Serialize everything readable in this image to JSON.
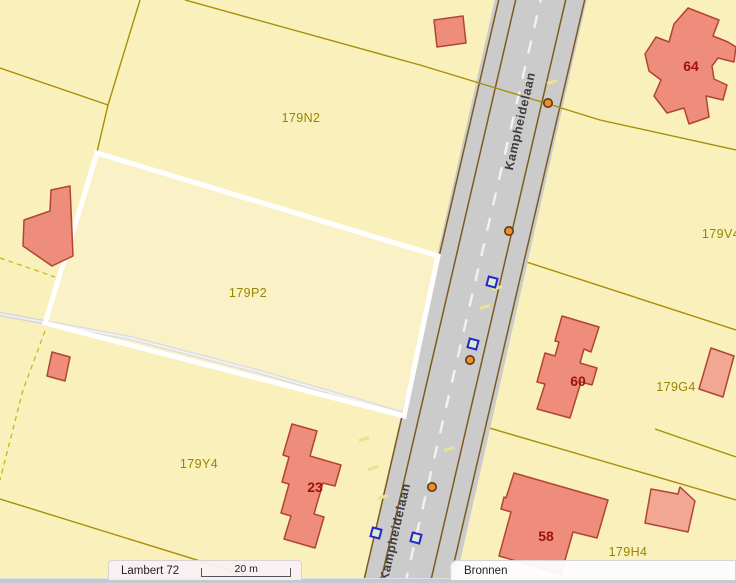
{
  "map": {
    "road_name_labels": [
      {
        "text": "Kampheidelaan",
        "x": 524,
        "y": 122,
        "rotation": -77
      },
      {
        "text": "Kampheidelaan",
        "x": 399,
        "y": 533,
        "rotation": -77
      }
    ],
    "parcel_labels": [
      {
        "text": "179N2",
        "x": 301,
        "y": 122
      },
      {
        "text": "179P2",
        "x": 248,
        "y": 297
      },
      {
        "text": "179V4",
        "x": 721,
        "y": 238
      },
      {
        "text": "179G4",
        "x": 676,
        "y": 391
      },
      {
        "text": "179Y4",
        "x": 199,
        "y": 468
      },
      {
        "text": "179H4",
        "x": 628,
        "y": 556
      }
    ],
    "building_labels": [
      {
        "text": "64",
        "x": 691,
        "y": 71
      },
      {
        "text": "60",
        "x": 578,
        "y": 386
      },
      {
        "text": "23",
        "x": 315,
        "y": 492
      },
      {
        "text": "58",
        "x": 546,
        "y": 541
      }
    ],
    "selected_parcel": "179P2",
    "markers": {
      "orange_points": [
        {
          "x": 548,
          "y": 103
        },
        {
          "x": 509,
          "y": 231
        },
        {
          "x": 470,
          "y": 360
        },
        {
          "x": 432,
          "y": 487
        }
      ],
      "blue_squares": [
        {
          "x": 492,
          "y": 282
        },
        {
          "x": 473,
          "y": 344
        },
        {
          "x": 376,
          "y": 533
        },
        {
          "x": 416,
          "y": 538
        }
      ],
      "access_dashes": [
        {
          "x": 552,
          "y": 82
        },
        {
          "x": 497,
          "y": 288
        },
        {
          "x": 485,
          "y": 307
        },
        {
          "x": 364,
          "y": 439
        },
        {
          "x": 373,
          "y": 468
        },
        {
          "x": 383,
          "y": 497
        },
        {
          "x": 449,
          "y": 449
        }
      ]
    },
    "colors": {
      "parcel_fill": "#faf0bc",
      "parcel_line": "#a68f05",
      "selection_outline": "#ffffff",
      "road_fill": "#cbcbcb",
      "road_edge": "#7d5a1e",
      "building_fill": "#ee8d7b",
      "building_fill_light": "#f2a795",
      "building_stroke": "#b04533",
      "parcel_label": "#9a8500",
      "building_label": "#9c120c",
      "road_label": "#3b3b40",
      "orange_marker": "#ef8f2a",
      "blue_marker_border": "#2626c9",
      "blue_marker_fill": "#d7ecd2",
      "dash_marker": "#e9e193",
      "track_gray": "#d6d6d6"
    }
  },
  "statusbar": {
    "projection_label": "Lambert 72",
    "scale_label": "20 m",
    "sources_label": "Bronnen"
  }
}
